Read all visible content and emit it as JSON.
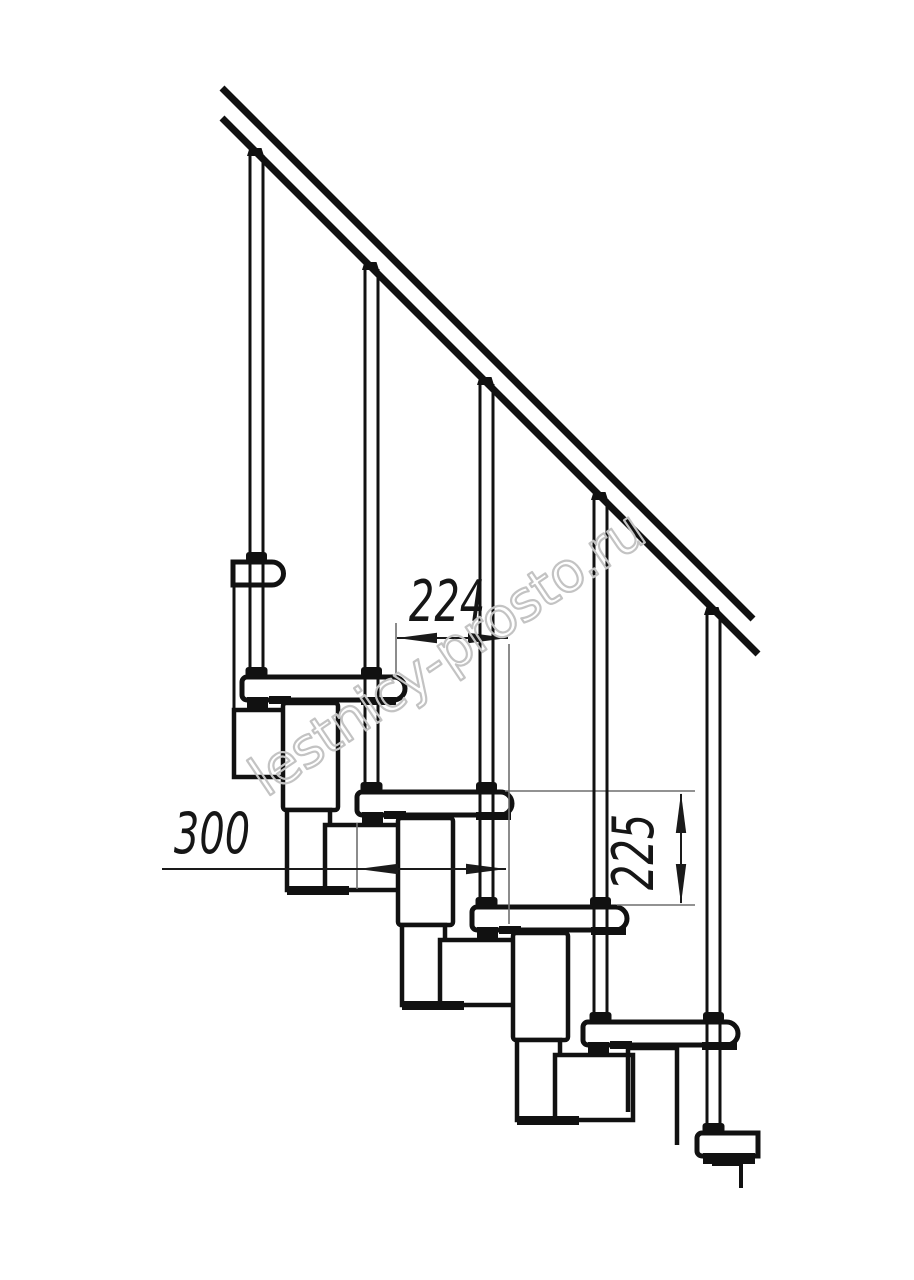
{
  "watermark": {
    "text": "lestnicy-prosto.ru"
  },
  "dimensions": {
    "step_run_label": "224",
    "tread_length_label": "300",
    "step_rise_label": "225"
  },
  "colors": {
    "line": "#111111",
    "thin_line": "#6f6f6f",
    "dimension": "#1a1a1a",
    "watermark": "#c3c3c3",
    "background": "#ffffff"
  }
}
